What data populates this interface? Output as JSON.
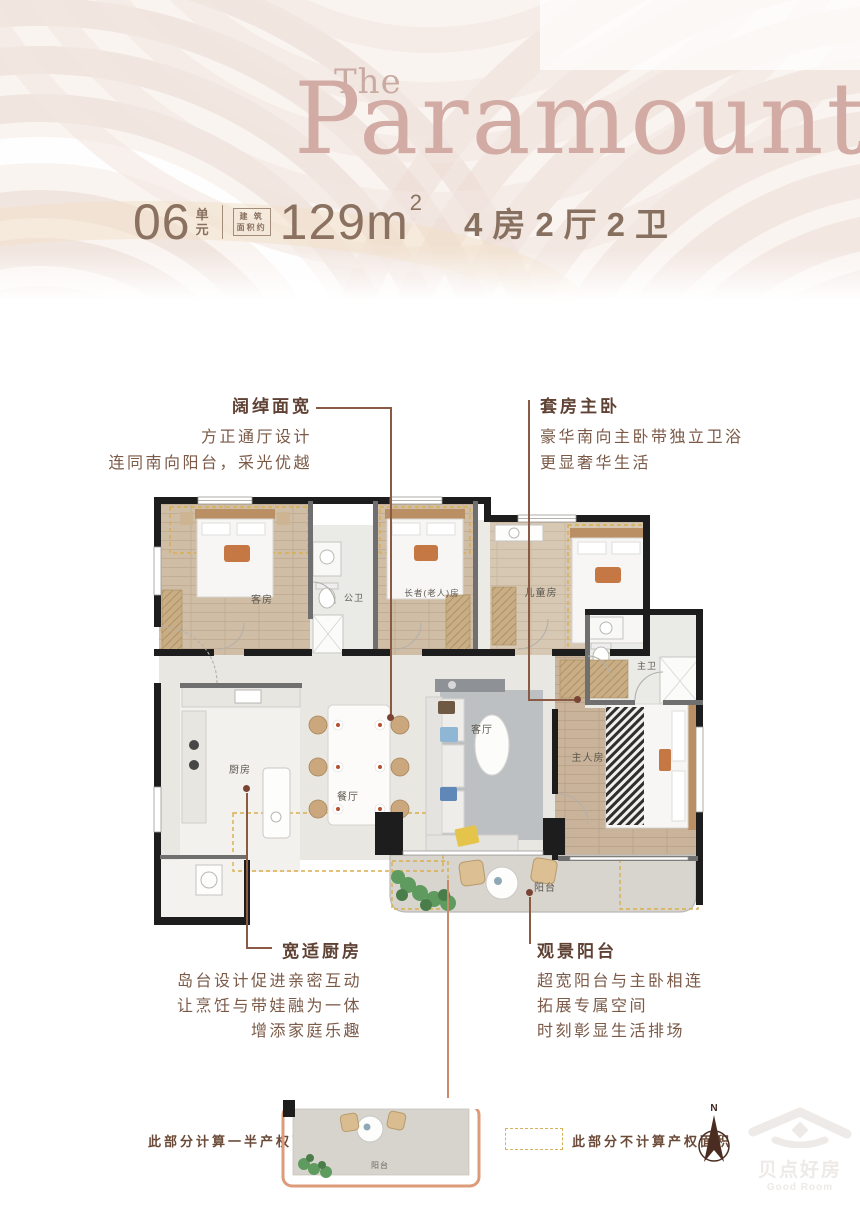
{
  "brand": {
    "prefix": "The",
    "name": "Paramount"
  },
  "header": {
    "unit_number": "06",
    "unit_suffix_top": "单",
    "unit_suffix_bottom": "元",
    "area_box_line1": "建 筑",
    "area_box_line2": "面积约",
    "area_value": "129m",
    "area_sup": "2",
    "layout_text": "4房2厅2卫"
  },
  "annotations": {
    "top_left": {
      "title": "阔绰面宽",
      "lines": [
        "方正通厅设计",
        "连同南向阳台，采光优越"
      ]
    },
    "top_right": {
      "title": "套房主卧",
      "lines": [
        "豪华南向主卧带独立卫浴",
        "更显奢华生活"
      ]
    },
    "bottom_left": {
      "title": "宽适厨房",
      "lines": [
        "岛台设计促进亲密互动",
        "让烹饪与带娃融为一体",
        "增添家庭乐趣"
      ]
    },
    "bottom_right": {
      "title": "观景阳台",
      "lines": [
        "超宽阳台与主卧相连",
        "拓展专属空间",
        "时刻彰显生活排场"
      ]
    }
  },
  "floorplan": {
    "rooms": {
      "guest": "客房",
      "public_bath": "公卫",
      "elder": "长者(老人)房",
      "child": "儿童房",
      "master_bath": "主卫",
      "master": "主人房",
      "kitchen": "厨房",
      "dining": "餐厅",
      "living": "客厅",
      "balcony": "阳台"
    }
  },
  "legend": {
    "half_area_text": "此部分计算一半产权面积",
    "excluded_area_text": "此部分不计算产权面积",
    "mini_balcony_label": "阳台",
    "compass_n": "N"
  },
  "watermark": {
    "cn": "贝点好房",
    "en": "Good Room"
  },
  "colors": {
    "brand_rose": "#d2aba4",
    "header_brown": "#8a7160",
    "text_brown": "#7b5a48",
    "title_brown": "#5f4234",
    "leader_brown": "#8a5a44",
    "wall_black": "#1d1d1d",
    "dashed_amber": "#d9ae4e",
    "mini_outline_salmon": "#dd9b79"
  }
}
